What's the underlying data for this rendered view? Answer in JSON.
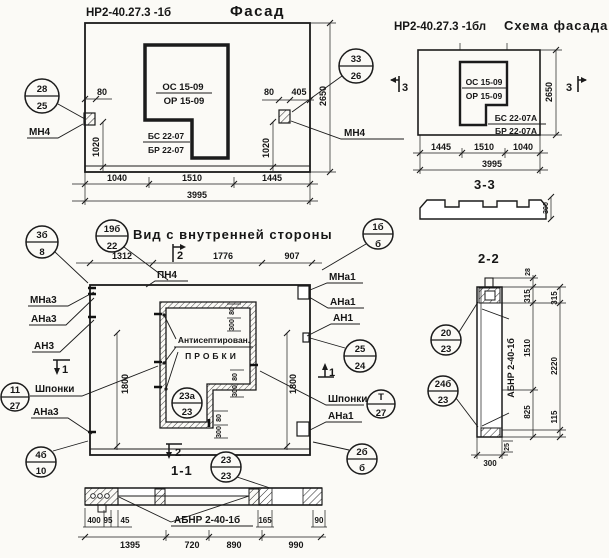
{
  "facade": {
    "code": "НР2-40.27.3 -1б",
    "title": "Фасад",
    "window": {
      "os": "ОС 15-09",
      "or": "ОР 15-09",
      "bs": "БС 22-07",
      "br": "БР 22-07"
    },
    "anchor": "МН4",
    "dims": {
      "left_off": "80",
      "left_h": "1020",
      "right_off": "80",
      "right_off2": "405",
      "right_h": "1020",
      "height": "2650",
      "bottom": [
        "1040",
        "1510",
        "1445"
      ],
      "total": "3995"
    },
    "callout_left": {
      "t": "28",
      "b": "25"
    },
    "callout_right": {
      "t": "33",
      "b": "26"
    }
  },
  "scheme": {
    "code": "НР2-40.27.3 -1бл",
    "title": "Схема фасада",
    "window": {
      "os": "ОС 15-09",
      "or": "ОР 15-09",
      "bs": "БС 22-07А",
      "br": "БР 22-07А"
    },
    "dims": {
      "height": "2650",
      "bottom": [
        "1445",
        "1510",
        "1040"
      ],
      "total": "3995",
      "profile": "300"
    },
    "marker": "3",
    "section_label": "3-3"
  },
  "inner": {
    "title": "Вид с внутренней стороны",
    "pn4": "ПН4",
    "note1": "Антисептирован.",
    "note2": "ПРОБКИ",
    "shponki": "Шпонки",
    "labels_left": {
      "mna3": "МНа3",
      "ana3": "АНа3",
      "an3": "АН3",
      "ana3b": "АНа3"
    },
    "labels_right": {
      "mna1": "МНа1",
      "ana1": "АНа1",
      "an1": "АН1",
      "ana1b": "АНа1"
    },
    "dims": {
      "top": [
        "1312",
        "1776",
        "907"
      ],
      "h_left": "1800",
      "h_right": "1800",
      "small_w": "80",
      "small_h": "300"
    },
    "marker1": "1",
    "marker2": "2",
    "section_label": "1-1",
    "callouts": {
      "c19": {
        "t": "19б",
        "b": "22"
      },
      "c1b": {
        "t": "1б",
        "b": "б"
      },
      "c3b": {
        "t": "3б",
        "b": "8"
      },
      "c11": {
        "t": "11",
        "b": "27"
      },
      "c4b": {
        "t": "4б",
        "b": "10"
      },
      "c25": {
        "t": "25",
        "b": "24"
      },
      "ct": {
        "t": "Т",
        "b": "27"
      },
      "c2b": {
        "t": "2б",
        "b": "б"
      },
      "c23a": {
        "t": "23а",
        "b": "23"
      },
      "c23": {
        "t": "23",
        "b": "23"
      }
    }
  },
  "s11": {
    "label": "АБНР 2-40-1б",
    "dims": {
      "row1": [
        "400",
        "95",
        "45"
      ],
      "d165": "165",
      "d90": "90",
      "row2": [
        "1395",
        "720",
        "890",
        "990"
      ]
    }
  },
  "s22": {
    "title": "2-2",
    "label": "АБНР 2-40-1б",
    "dims": {
      "d28": "28",
      "inner": [
        "315",
        "1510",
        "825"
      ],
      "outer": [
        "315",
        "2220",
        "115"
      ],
      "d25": "25",
      "width": "300"
    },
    "callouts": {
      "c20": {
        "t": "20",
        "b": "23"
      },
      "c24": {
        "t": "24б",
        "b": "23"
      }
    }
  }
}
